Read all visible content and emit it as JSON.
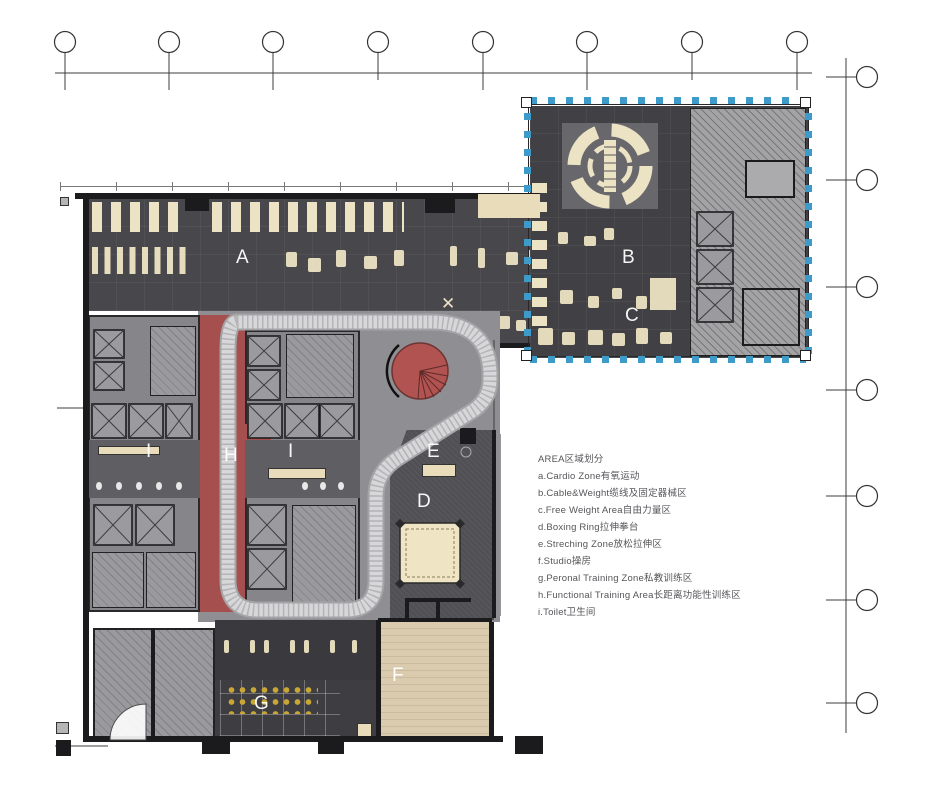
{
  "drawing": {
    "type": "gym-floor-plan",
    "legend": {
      "title": "AREA区域划分",
      "items": [
        "a.Cardio Zone有氧运动",
        "b.Cable&Weight缆线及固定器械区",
        "c.Free Weight Area自由力量区",
        "d.Boxing Ring拉伸拳台",
        "e.Streching Zone放松拉伸区",
        "f.Studio操房",
        "g.Peronal Training Zone私教训练区",
        "h.Functional Training Area长距离功能性训练区",
        "i.Toilet卫生间"
      ]
    },
    "zones": {
      "A": "A",
      "B": "B",
      "C": "C",
      "D": "D",
      "E": "E",
      "F": "F",
      "G": "G",
      "H": "H",
      "I": "I"
    },
    "colors": {
      "floor_dark": "#48484c",
      "floor_medium": "#8f8f93",
      "accent_red": "#a5504e",
      "equipment_cream": "#ece2c4",
      "wood_floor": "#d8c8aa",
      "marker_blue": "#3e9bc9",
      "dots_yellow": "#c9a636"
    }
  }
}
